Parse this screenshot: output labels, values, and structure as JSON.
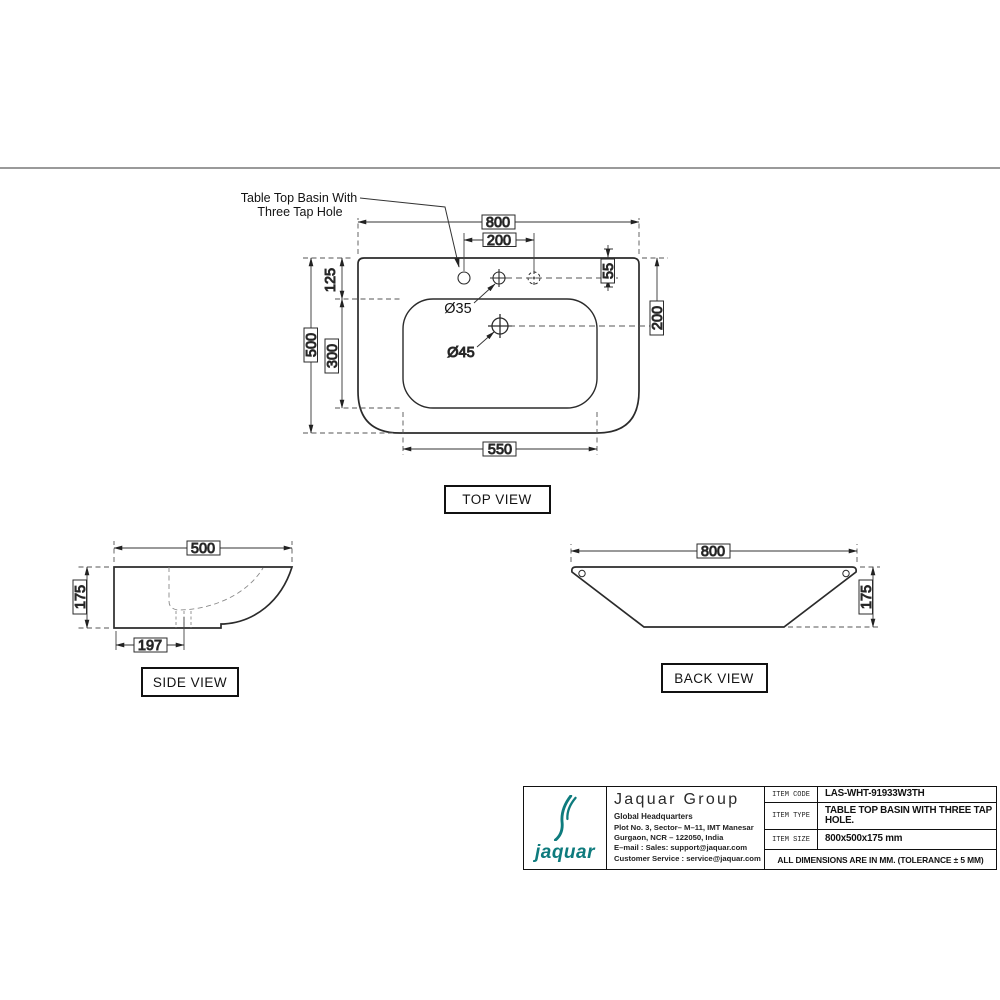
{
  "annotation": {
    "line1": "Table Top Basin With",
    "line2": "Three Tap Hole"
  },
  "top_view": {
    "label": "TOP VIEW",
    "dim_width": "800",
    "dim_tap_spacing": "200",
    "dim_tap_offset": "55",
    "dim_drain_offset": "200",
    "dim_rim_to_bowl": "125",
    "dim_depth": "500",
    "dim_bowl_depth": "300",
    "dim_bowl_width": "550",
    "tap_hole_dia": "Ø35",
    "drain_hole_dia": "Ø45"
  },
  "side_view": {
    "label": "SIDE VIEW",
    "dim_depth": "500",
    "dim_height": "175",
    "dim_drain_pos": "197"
  },
  "back_view": {
    "label": "BACK VIEW",
    "dim_width": "800",
    "dim_height": "175"
  },
  "title_block": {
    "brand_color": "#0e7b7d",
    "logo_text": "jaquar",
    "company": "Jaquar Group",
    "hq": "Global Headquarters",
    "address1": "Plot No. 3, Sector– M–11, IMT Manesar",
    "address2": "Gurgaon, NCR – 122050, India",
    "address3": "E–mail : Sales: support@jaquar.com",
    "address4": "Customer Service : service@jaquar.com",
    "rows": [
      {
        "label": "ITEM CODE",
        "value": "LAS-WHT-91933W3TH"
      },
      {
        "label": "ITEM TYPE",
        "value": "TABLE TOP BASIN WITH THREE TAP HOLE."
      },
      {
        "label": "ITEM SIZE",
        "value": "800x500x175 mm"
      }
    ],
    "note": "ALL DIMENSIONS ARE IN MM. (TOLERANCE ± 5 MM)"
  }
}
